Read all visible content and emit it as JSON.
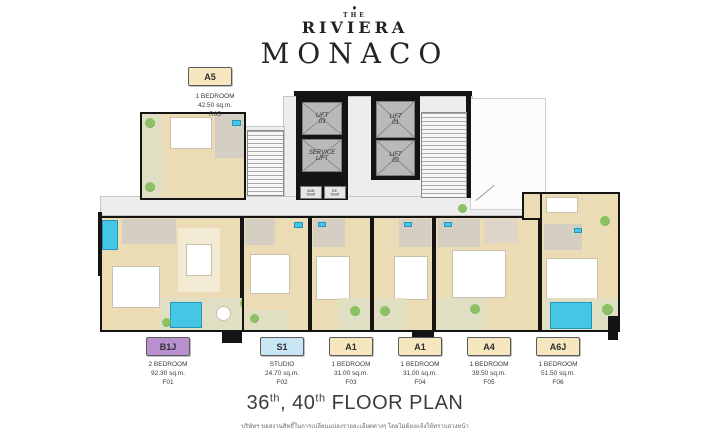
{
  "header": {
    "ornament": "♦",
    "the": "THE",
    "brand": "RIVIERA",
    "project": "MONACO"
  },
  "plan": {
    "lifts": [
      {
        "label": "LIFT\n03"
      },
      {
        "label": "SERVICE\nLIFT"
      },
      {
        "label": "LIFT\n01"
      },
      {
        "label": "LIFT\n02"
      }
    ],
    "shafts": [
      {
        "label": "SAN\nShaft"
      },
      {
        "label": "EE\nShaft"
      }
    ],
    "colors": {
      "wall": "#141414",
      "floor": "#ecdcb6",
      "bathroom": "#d5cec2",
      "balcony": "#e0dfc4",
      "corridor": "#ededed",
      "water": "#45c6e6",
      "plant": "#6faf4f",
      "lift_cab": "#b9b9b9"
    }
  },
  "unit_top": {
    "id": "A5",
    "type": "1 BEDROOM",
    "area": "42.50 sq.m.",
    "code": "R05",
    "box_color": "#f6e7c1"
  },
  "units": [
    {
      "id": "B1J",
      "type": "2 BEDROOM",
      "area": "92.30 sq.m.",
      "code": "F01",
      "box_color": "#b990cf"
    },
    {
      "id": "S1",
      "type": "STUDIO",
      "area": "24.70 sq.m.",
      "code": "F02",
      "box_color": "#c8e6f4"
    },
    {
      "id": "A1",
      "type": "1 BEDROOM",
      "area": "31.00 sq.m.",
      "code": "F03",
      "box_color": "#f6e7c1"
    },
    {
      "id": "A1",
      "type": "1 BEDROOM",
      "area": "31.00 sq.m.",
      "code": "F04",
      "box_color": "#f6e7c1"
    },
    {
      "id": "A4",
      "type": "1 BEDROOM",
      "area": "39.50 sq.m.",
      "code": "F05",
      "box_color": "#f6e7c1"
    },
    {
      "id": "A6J",
      "type": "1 BEDROOM",
      "area": "51.50 sq.m.",
      "code": "F06",
      "box_color": "#f6e7c1"
    }
  ],
  "footer": {
    "n1": "36",
    "s1": "th",
    "mid": ", 40",
    "s2": "th",
    "rest": " FLOOR PLAN",
    "disclaimer": "บริษัทฯ ขอสงวนสิทธิ์ในการเปลี่ยนแปลงรายละเอียดต่างๆ โดยไม่ต้องแจ้งให้ทราบล่วงหน้า"
  }
}
